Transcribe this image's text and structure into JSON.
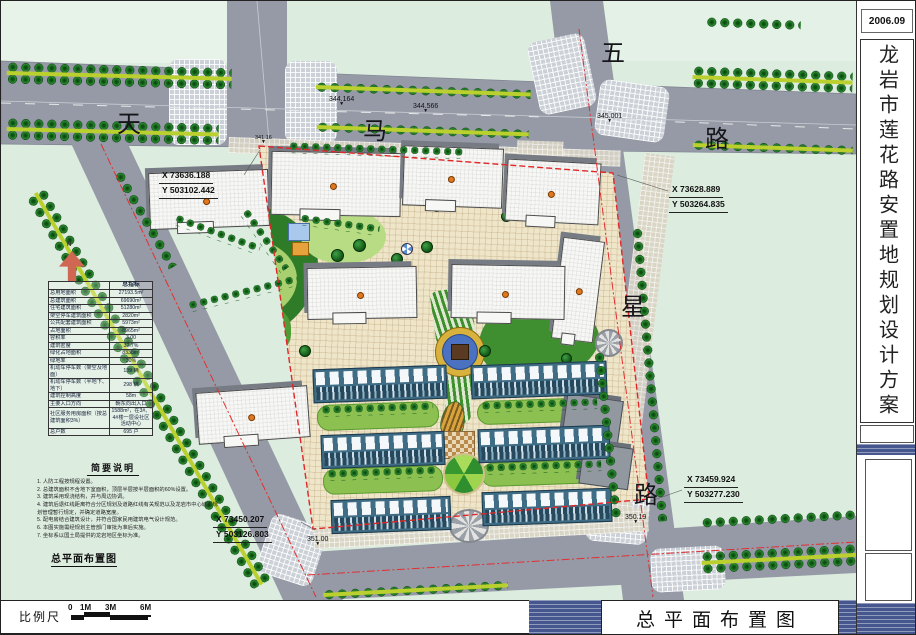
{
  "frame": {
    "date": "2006.09",
    "side_title": "龙岩市莲花路安置地规划设计方案",
    "main_title": "总平面布置图",
    "plan_caption": "总平面布置图",
    "notes_title": "简要说明",
    "scale_label": "比例尺",
    "scale_ticks": [
      "0",
      "1M",
      "3M",
      "6M"
    ],
    "north_label": "N"
  },
  "roads": {
    "tianma": [
      "天",
      "马",
      "路"
    ],
    "wuxing": [
      "五",
      "星",
      "路"
    ]
  },
  "elevations": [
    "344.164",
    "344.566",
    "345.001",
    "341.16",
    "350.19",
    "351.00"
  ],
  "coords": [
    {
      "x": "X 73636.188",
      "y": "Y 503102.442"
    },
    {
      "x": "X 73628.889",
      "y": "Y 503264.835"
    },
    {
      "x": "X 73459.924",
      "y": "Y 503277.230"
    },
    {
      "x": "X 73450.207",
      "y": "Y 503126.803"
    }
  ],
  "indicators": {
    "title": "总指标",
    "rows": [
      [
        "总用地面积",
        "27193.5m²"
      ],
      [
        "总建筑面积",
        "69690m²"
      ],
      [
        "住宅建筑面积",
        "51280m²"
      ],
      [
        "架空停车建筑面积",
        "2820m²"
      ],
      [
        "公共配套建筑面积",
        "5973m²"
      ],
      [
        "占地面积",
        "8965m²"
      ],
      [
        "容积率",
        "3.00"
      ],
      [
        "建筑密度",
        "32.7%"
      ],
      [
        "绿化占地面积",
        "8338m²"
      ],
      [
        "绿地率",
        "30%"
      ],
      [
        "机动车停车数（架空及地面）",
        "139 辆"
      ],
      [
        "机动车停车数（半地下、地下）",
        "298 辆"
      ],
      [
        "建筑控制高度",
        "58m"
      ],
      [
        "主要入口方向",
        "朝东向出入口"
      ],
      [
        "社区服务用房面积（按总建筑面积3%）",
        "1588m²，在3#、4#楼一层设社区活动中心"
      ],
      [
        "总户数",
        "695 户"
      ]
    ]
  },
  "notes": {
    "items": [
      "1. 人防工程按规程设置。",
      "2. 总建筑面积不含地下室面积，顶层半层按半层面积的60%设置。",
      "3. 建筑采用现浇结构，并与周边协调。",
      "4. 建筑后退红线距离符合分区规划及道路红线有关规范以及龙岩市中心城市规划管理暂行规定，并确定道路宽度。",
      "5. 配电房结合建筑设计，并符合国家民用建筑电气设计规范。",
      "6. 本图实施需经规划主管部门审批为准后实施。",
      "7. 坐标系以国土局提供的龙岩地区坐标为准。"
    ]
  },
  "colors": {
    "boundary_red": "#e02828",
    "road_gray": "#959aa6",
    "tree_green": "#1e7a24",
    "site_beige": "#efe5c9",
    "townhouse_teal": "#3f6d86",
    "band_blue": "#46568e"
  }
}
